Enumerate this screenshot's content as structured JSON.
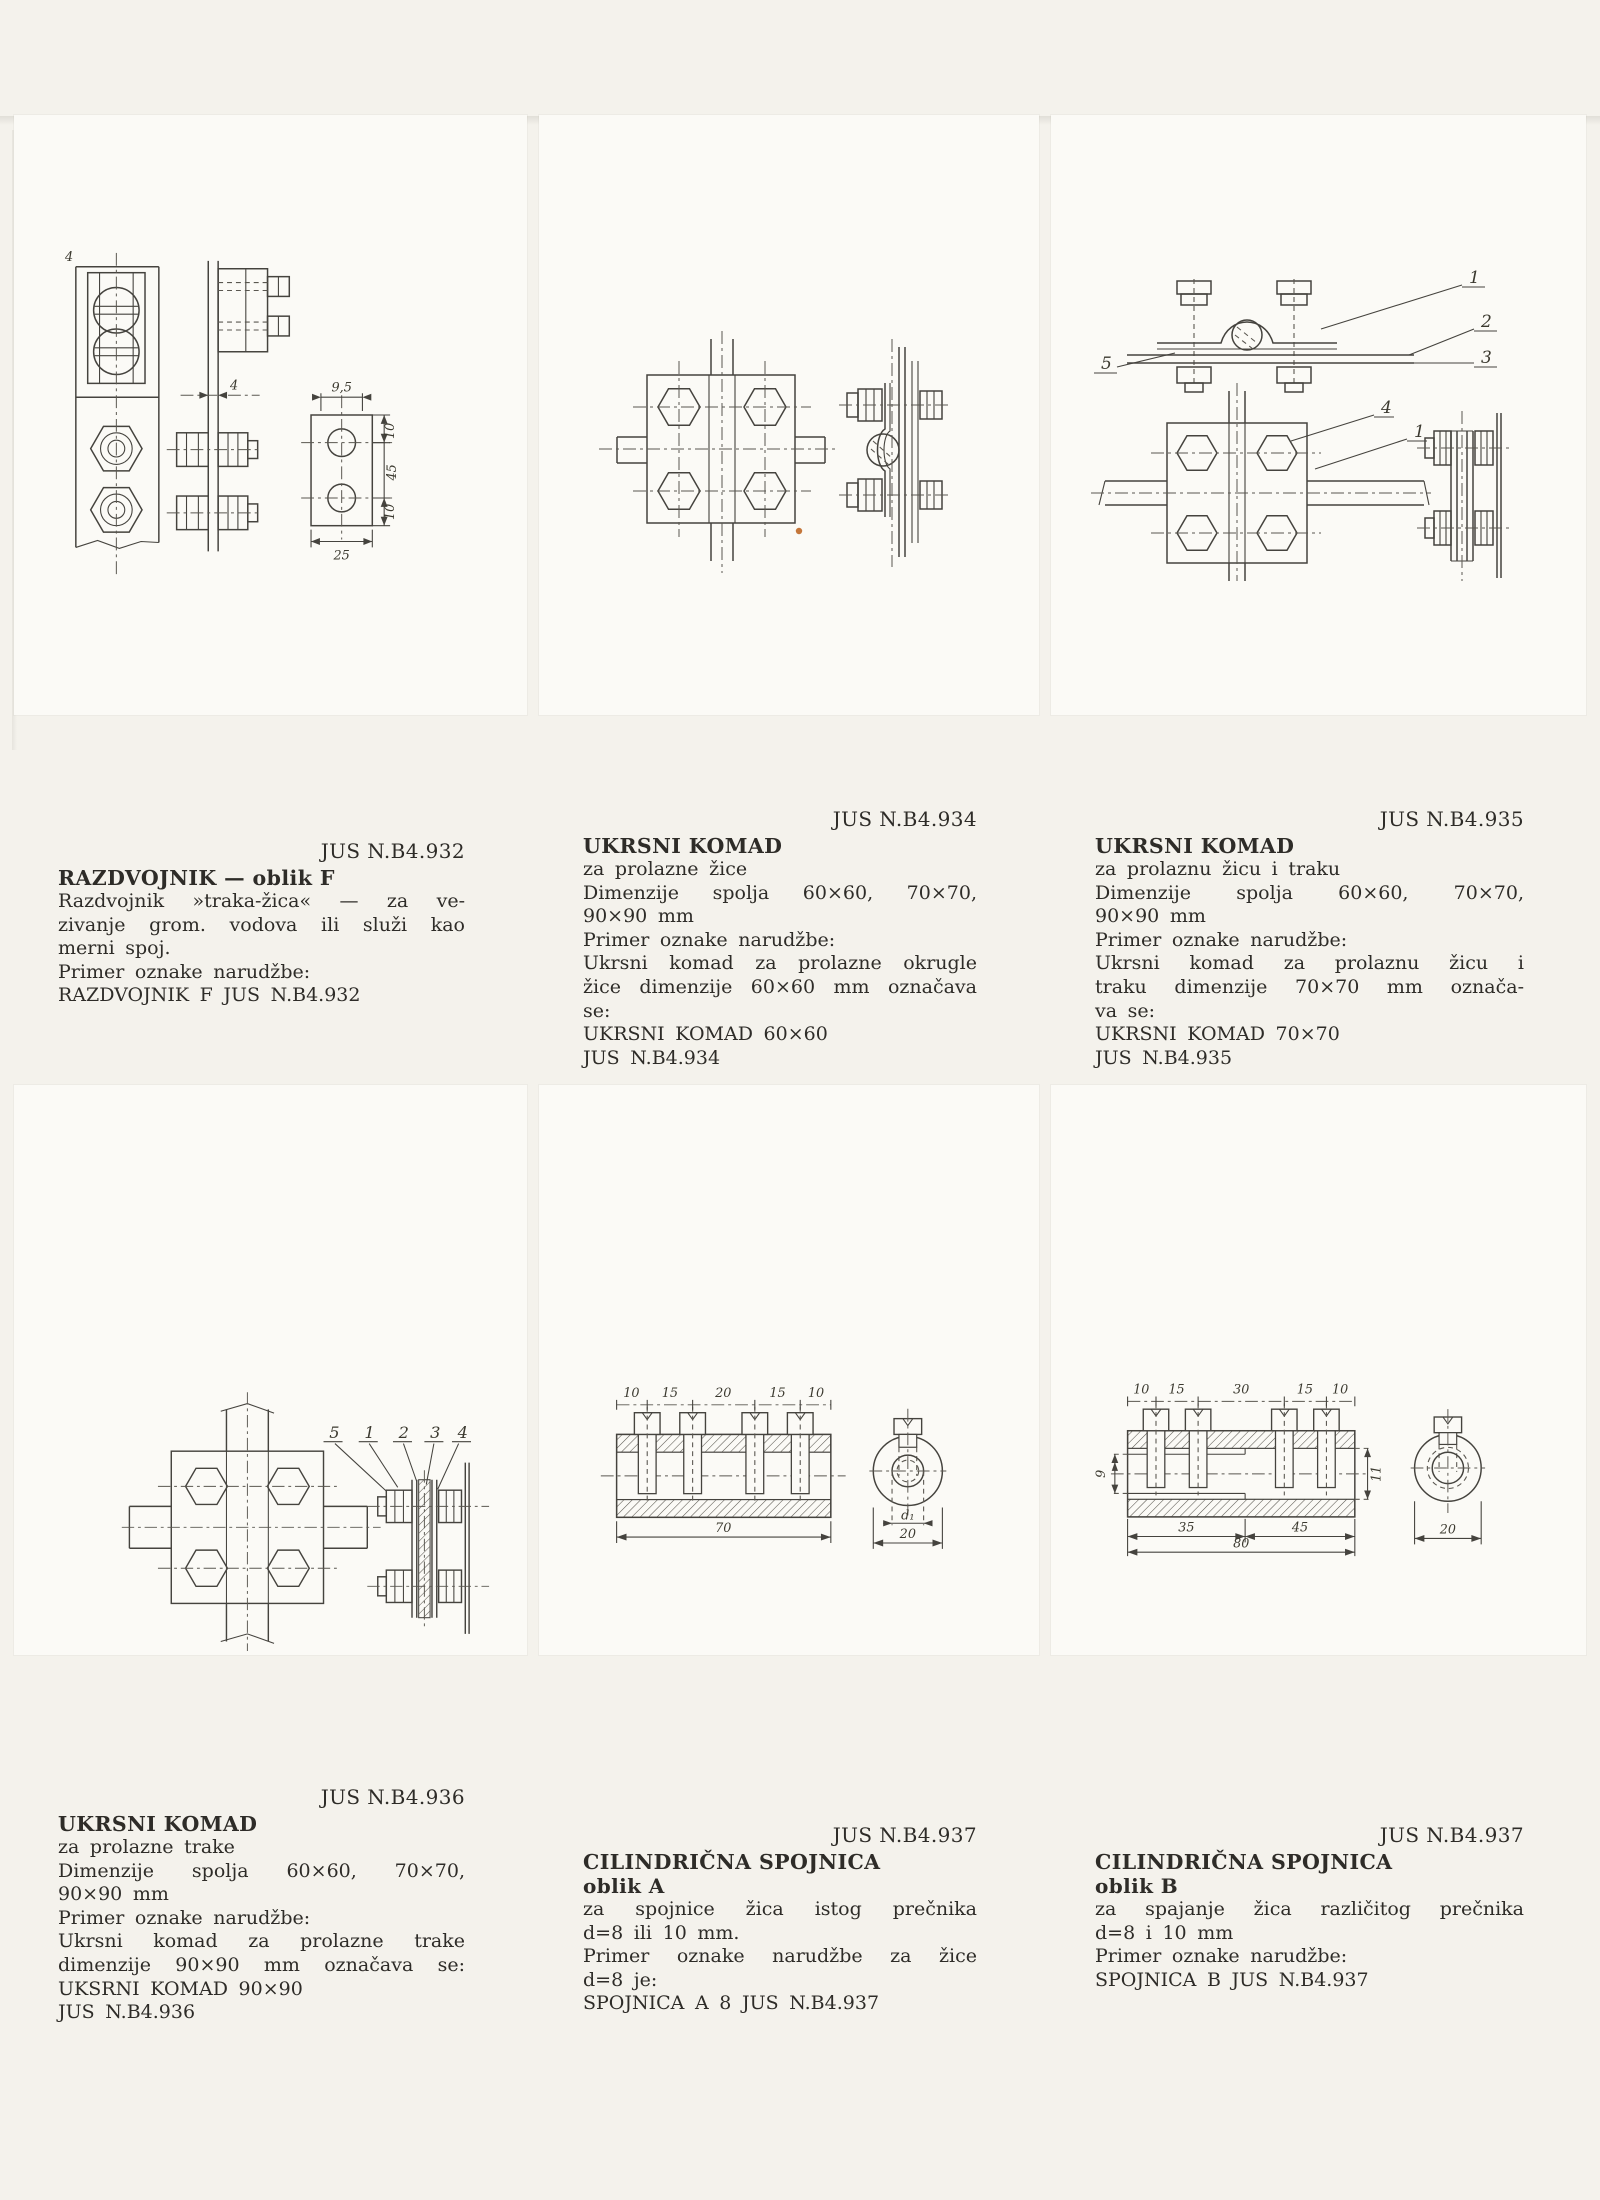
{
  "colors": {
    "paper": "#f4f2ec",
    "card": "#fbfaf6",
    "ink": "#2e2c28",
    "line": "#45433e"
  },
  "panels": [
    {
      "code": "JUS N.B4.932",
      "title": "RAZDVOJNIK — oblik F",
      "subtitle": "",
      "body": [
        "Razdvojnik »traka-žica« — za ve-",
        "zivanje grom. vodova ili služi kao",
        "merni spoj.",
        "Primer oznake narudžbe:",
        "RAZDVOJNIK F JUS N.B4.932"
      ]
    },
    {
      "code": "JUS N.B4.934",
      "title": "UKRSNI KOMAD",
      "subtitle": "",
      "body": [
        "za prolazne žice",
        "Dimenzije spolja 60×60, 70×70,",
        "90×90 mm",
        "Primer oznake narudžbe:",
        "Ukrsni komad za prolazne okrugle",
        "žice dimenzije 60×60 mm označava",
        "se:",
        "UKRSNI KOMAD 60×60",
        "JUS N.B4.934"
      ]
    },
    {
      "code": "JUS N.B4.935",
      "title": "UKRSNI KOMAD",
      "subtitle": "",
      "body": [
        "za prolaznu žicu i traku",
        "Dimenzije spolja 60×60, 70×70,",
        "90×90 mm",
        "Primer oznake narudžbe:",
        "Ukrsni komad za prolaznu žicu i",
        "traku dimenzije 70×70 mm označa-",
        "va se:",
        "UKRSNI KOMAD 70×70",
        "JUS N.B4.935"
      ]
    },
    {
      "code": "JUS N.B4.936",
      "title": "UKRSNI KOMAD",
      "subtitle": "",
      "body": [
        "za prolazne trake",
        "Dimenzije spolja 60×60, 70×70,",
        "90×90 mm",
        "Primer oznake narudžbe:",
        "Ukrsni komad za prolazne trake",
        "dimenzije 90×90 mm označava se:",
        "UKSRNI KOMAD 90×90",
        "JUS N.B4.936"
      ]
    },
    {
      "code": "JUS N.B4.937",
      "title": "CILINDRIČNA SPOJNICA",
      "subtitle": "oblik A",
      "body": [
        "za spojnice žica istog prečnika",
        "d=8 ili 10 mm.",
        "Primer oznake narudžbe za žice",
        "d=8 je:",
        "SPOJNICA A 8 JUS N.B4.937"
      ]
    },
    {
      "code": "JUS N.B4.937",
      "title": "CILINDRIČNA SPOJNICA",
      "subtitle": "oblik B",
      "body": [
        "za spajanje žica različitog prečnika",
        "d=8 i 10 mm",
        "Primer oznake narudžbe:",
        "SPOJNICA B JUS N.B4.937"
      ]
    }
  ],
  "drawings": {
    "d932": {
      "t4_front": "4",
      "t4_side": "4",
      "w95": "9,5",
      "r10a": "10",
      "r45": "45",
      "r10b": "10",
      "b25": "25"
    },
    "d935": {
      "c1a": "1",
      "c2": "2",
      "c3": "3",
      "c5": "5",
      "c4": "4",
      "c1b": "1"
    },
    "d936": {
      "c5": "5",
      "c1": "1",
      "c2": "2",
      "c3": "3",
      "c4": "4"
    },
    "d937a": {
      "seg": [
        "10",
        "15",
        "20",
        "15",
        "10"
      ],
      "total": "70",
      "d1": "d₁",
      "dia": "20"
    },
    "d937b": {
      "seg": [
        "10",
        "15",
        "30",
        "15",
        "10"
      ],
      "left": "9",
      "right": "11",
      "b1": "35",
      "b2": "45",
      "b3": "80",
      "dia": "20"
    }
  }
}
